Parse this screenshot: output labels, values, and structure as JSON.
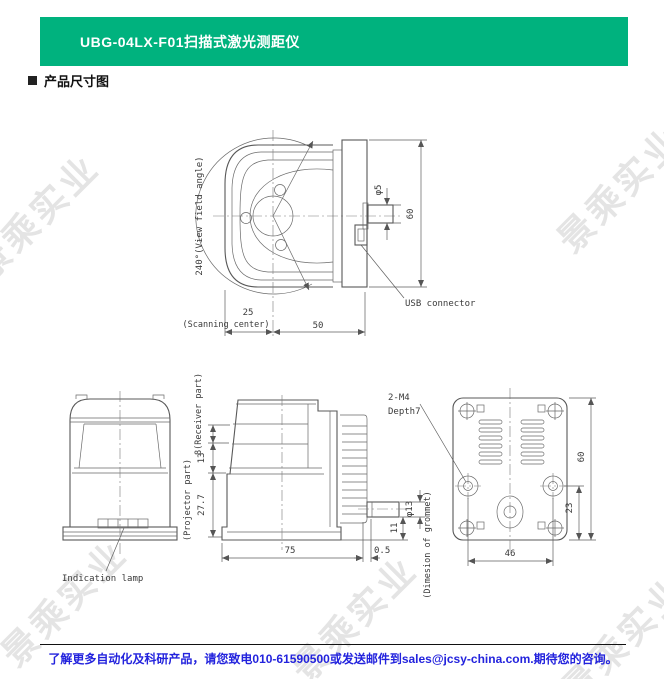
{
  "header": {
    "title": "UBG-04LX-F01扫描式激光测距仪",
    "bg_color": "#00B27E"
  },
  "section": {
    "title": "产品尺寸图"
  },
  "watermark": {
    "text": "景乘实业"
  },
  "top_view": {
    "view_field": "240°(View field angle)",
    "dim_25": "25",
    "scanning_center": "(Scanning center)",
    "dim_50": "50",
    "phi5": "φ5",
    "dim_60": "60",
    "usb": "USB connector"
  },
  "front_view": {
    "indication_lamp": "Indication lamp"
  },
  "side_view": {
    "receiver": "8(Receiver part)",
    "dim_13": "13",
    "dim_27_7": "27.7",
    "projector": "(Projector part)",
    "dim_75": "75",
    "dim_0_5": "0.5",
    "dim_11": "11",
    "phi13": "φ13",
    "grommet": "(Dimesion of grommet)",
    "m4_line1": "2-M4",
    "m4_line2": "Depth7"
  },
  "rear_view": {
    "dim_60": "60",
    "dim_23": "23",
    "dim_46": "46"
  },
  "footer": {
    "contact": "了解更多自动化及科研产品，请您致电010-61590500或发送邮件到sales@jcsy-china.com.期待您的咨询。",
    "text_color": "#2323DD"
  }
}
